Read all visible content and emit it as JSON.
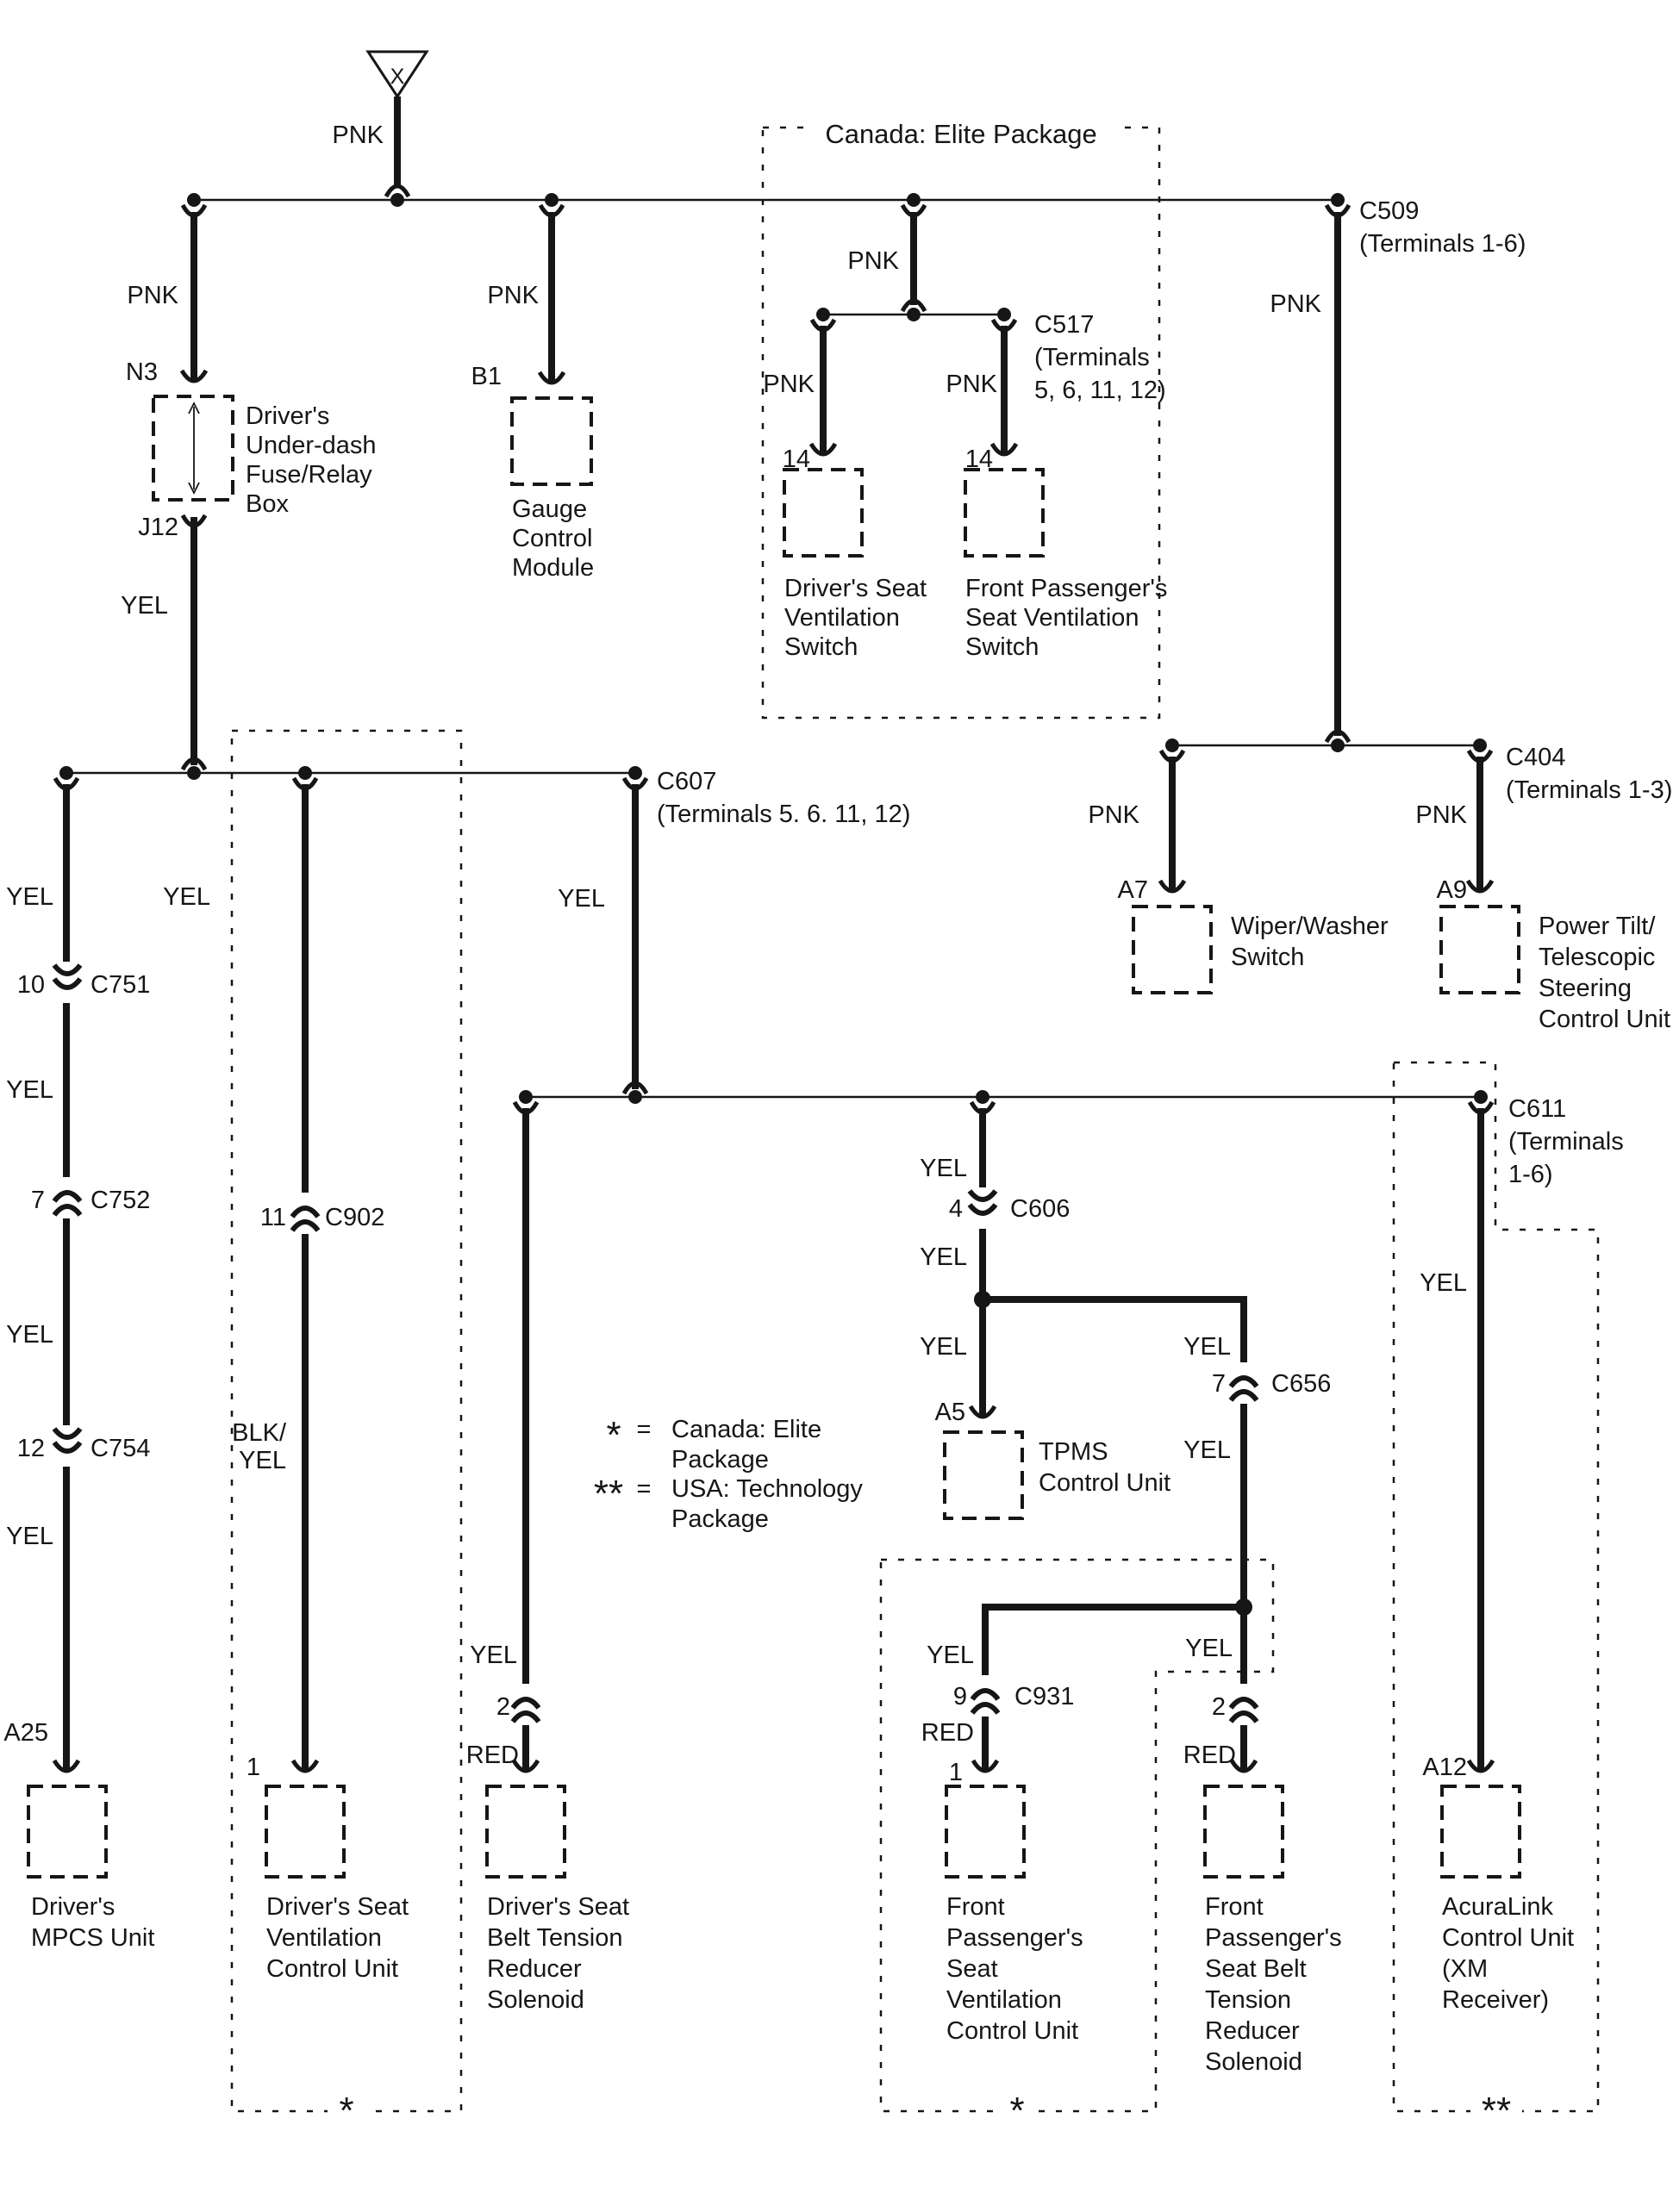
{
  "source": {
    "symbol": "X"
  },
  "colors": {
    "pnk": "PNK",
    "yel": "YEL",
    "red": "RED",
    "blk_slash": "BLK/"
  },
  "pins": {
    "n3": "N3",
    "j12": "J12",
    "b1": "B1",
    "p14": "14",
    "p10": "10",
    "p7": "7",
    "p12": "12",
    "p11": "11",
    "p4": "4",
    "p9": "9",
    "p1": "1",
    "p2": "2",
    "a5": "A5",
    "a7": "A7",
    "a9": "A9",
    "a12": "A12",
    "a25": "A25"
  },
  "connectors": {
    "c751": "C751",
    "c752": "C752",
    "c754": "C754",
    "c902": "C902",
    "c606": "C606",
    "c656": "C656",
    "c931": "C931",
    "c607": "C607",
    "c607_terms": "(Terminals 5. 6. 11, 12)",
    "c509": "C509",
    "c509_terms": "(Terminals 1-6)",
    "c517": "C517",
    "c517_terms_1": "(Terminals",
    "c517_terms_2": "5, 6, 11, 12)",
    "c404": "C404",
    "c404_terms": "(Terminals 1-3)",
    "c611": "C611",
    "c611_terms_1": "(Terminals",
    "c611_terms_2": "1-6)"
  },
  "packages": {
    "canada_title": "Canada: Elite Package",
    "star": "*",
    "double_star": "**"
  },
  "legend": {
    "eq": "=",
    "canada_line1": "Canada: Elite",
    "canada_line2": "Package",
    "usa_line1": "USA: Technology",
    "usa_line2": "Package"
  },
  "components": {
    "fuse_box": [
      "Driver's",
      "Under-dash",
      "Fuse/Relay",
      "Box"
    ],
    "gauge_module": [
      "Gauge",
      "Control",
      "Module"
    ],
    "driver_vent_switch": [
      "Driver's Seat",
      "Ventilation",
      "Switch"
    ],
    "front_vent_switch": [
      "Front Passenger's",
      "Seat Ventilation",
      "Switch"
    ],
    "wiper_switch": [
      "Wiper/Washer",
      "Switch"
    ],
    "tilt_unit": [
      "Power Tilt/",
      "Telescopic",
      "Steering",
      "Control Unit"
    ],
    "mpcs": [
      "Driver's",
      "MPCS Unit"
    ],
    "driver_vent_cu": [
      "Driver's Seat",
      "Ventilation",
      "Control Unit"
    ],
    "driver_belt": [
      "Driver's Seat",
      "Belt Tension",
      "Reducer",
      "Solenoid"
    ],
    "tpms": [
      "TPMS",
      "Control Unit"
    ],
    "front_vent_cu": [
      "Front",
      "Passenger's",
      "Seat",
      "Ventilation",
      "Control Unit"
    ],
    "front_belt": [
      "Front",
      "Passenger's",
      "Seat Belt",
      "Tension",
      "Reducer",
      "Solenoid"
    ],
    "acuralink": [
      "AcuraLink",
      "Control Unit",
      "(XM",
      "Receiver)"
    ]
  }
}
